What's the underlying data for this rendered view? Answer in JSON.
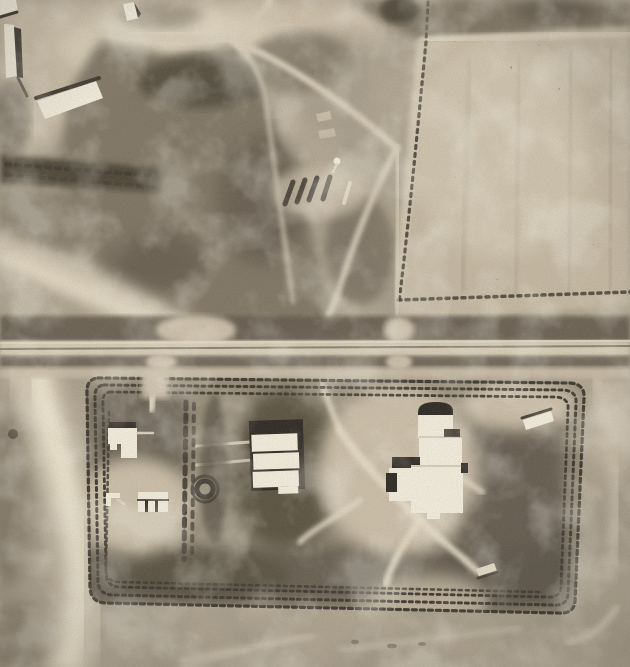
{
  "meta": {
    "title": "Black-and-white vertical aerial photograph of a rural site: farmstead, ploughed field, east-west road and a fenced rectangular compound with white buildings",
    "photo_type": "monochrome aerial photograph",
    "orientation": "vertical (plan view)"
  },
  "scene": {
    "features": [
      {
        "name": "farmstead-nw",
        "label": "farm yard with white barn and sheds, top-left"
      },
      {
        "name": "orchard-band",
        "label": "dark tree/orchard band running across the west side"
      },
      {
        "name": "scrub-center",
        "label": "dark scrubland with light tracks, top-center"
      },
      {
        "name": "field-ne",
        "label": "large pale ploughed field speckled with dark crop marks, top-right"
      },
      {
        "name": "barracks-row",
        "label": "row of small slatted structures in the scrub"
      },
      {
        "name": "highway",
        "label": "straight east-west road with dark verge scrub and thin centerline"
      },
      {
        "name": "compound",
        "label": "rectangular enclosure with 3-4 concentric dotted perimeter fences"
      },
      {
        "name": "l-building",
        "label": "small L-shaped white building, compound west"
      },
      {
        "name": "striped-shed",
        "label": "white shed with three gable bays"
      },
      {
        "name": "center-block",
        "label": "white block of three bars with dark flat roof, compound center"
      },
      {
        "name": "main-complex",
        "label": "large irregular white industrial complex with dark arched roof, compound east"
      },
      {
        "name": "ne-shed",
        "label": "small white shed near compound north-east corner"
      },
      {
        "name": "ring-feature",
        "label": "small dark circular emplacement"
      },
      {
        "name": "pipe-object",
        "label": "light cylindrical object lying in south-east vegetation"
      },
      {
        "name": "sandy-wash",
        "label": "bright sandy wash curving down the left edge"
      }
    ]
  },
  "palette": {
    "base": "#b2a691",
    "sand-light": "#cdc0a9",
    "sand-bright": "#e6dcc5",
    "wash": "#efe6cf",
    "field": "#c6b9a2",
    "scrub-mid": "#7b7161",
    "scrub-dark": "#60574a",
    "scrub-deep": "#463f33",
    "orchard": "#453d2f",
    "road": "#d9ceb8",
    "road-line": "#7a7061",
    "fence": "#38322a",
    "interior": "#968b77",
    "interior-dark": "#5c5346",
    "veg-dark": "#514939",
    "building": "#f7f1e0",
    "roof": "#26221c",
    "shadow": "#3a342b"
  }
}
